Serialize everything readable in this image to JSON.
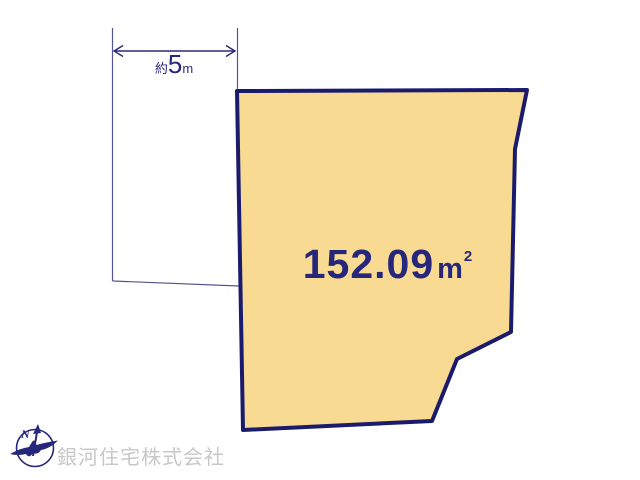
{
  "diagram": {
    "type": "real-estate-land-plot-drawing",
    "dimension_label": {
      "prefix": "約",
      "value": "5",
      "unit": "m"
    },
    "plot": {
      "area_value": "152.09",
      "area_unit": "m",
      "area_superscript": "2"
    },
    "compass": {
      "north_label": "N"
    },
    "watermark": {
      "company_name": "銀河住宅株式会社"
    },
    "colors": {
      "plot_fill": "#f8da92",
      "plot_outline": "#1b1b6e",
      "thin_boundary_line": "#55558f",
      "annotation_navy": "#28287a",
      "area_text_navy": "#26267a",
      "watermark_gray": "#c8c8c8",
      "background": "#ffffff"
    }
  }
}
